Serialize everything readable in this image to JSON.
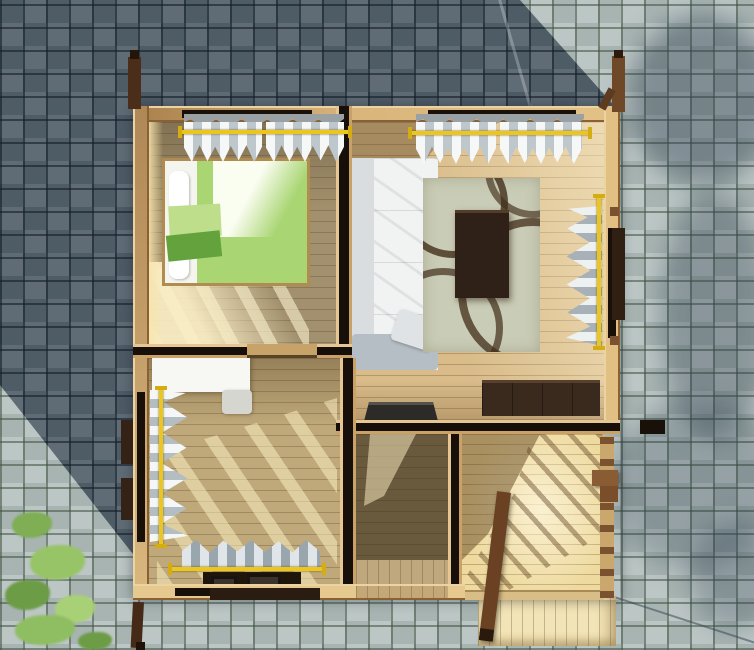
{
  "meta": {
    "type": "3d-architectural-render",
    "view": "top-down",
    "subject": "Single-storey wooden house interior seen from above, standing on a basketweave-paved courtyard",
    "lighting": "Sunlight from lower-right; building casts a large diagonal shadow over the paving to the upper-left",
    "image_size": "754x650"
  },
  "palette": {
    "paving_sunlit": "#b4bfbe",
    "paving_shadow": "#56646f",
    "paving_joint": "#3e5242",
    "wall_wood": "#cda269",
    "wall_gap_dark": "#191009",
    "floor_wood": "#c9ae7c",
    "floor_sunlit": "#f2e2b2",
    "bed_green": "#a9d673",
    "bed_green_dark": "#63a23c",
    "pillow_white": "#f5f5f0",
    "sofa_white": "#f1f3f3",
    "rug_sage": "#c9ccb6",
    "rug_swirl_brown": "#42301a",
    "coffee_table_brown": "#2f2018",
    "sideboard_brown": "#3a2a1d",
    "curtain_white": "#eef1f2",
    "curtain_gray": "#9aa6ad",
    "curtain_rod_yellow": "#ecc51e",
    "post_brown": "#4a2e1a",
    "shutter_brown": "#302013",
    "plant_green": "#8fbe62"
  },
  "ground": {
    "pattern": "basketweave concrete pavers with mossy joints",
    "building_shadow": "diagonal dark region covering upper-left paving",
    "tree_shadows": "soft foliage shadow patches along right edge",
    "plant": "green shrub in bottom-left corner",
    "cable_shadow": "thin diagonal line across bottom-right paving"
  },
  "house": {
    "structure": "log walls shown in cut top view with yellow curtain rods over window openings",
    "rooms": [
      {
        "id": "bedroom",
        "position": "top-left",
        "furniture": [
          "green double bed",
          "white headboard",
          "two white pillows",
          "dark-green folded blanket"
        ]
      },
      {
        "id": "living-room",
        "position": "top-right",
        "furniture": [
          "white sofa with cushions",
          "sage rug with brown swirl pattern",
          "dark-brown coffee table",
          "dark-brown sideboard",
          "dark stove block"
        ]
      },
      {
        "id": "second-room",
        "position": "bottom-left",
        "furniture": [
          "white desk",
          "light stool",
          "dark table with two trays"
        ]
      },
      {
        "id": "hallway",
        "position": "bottom-center",
        "furniture": []
      },
      {
        "id": "porch",
        "position": "bottom-right",
        "features": [
          "sunlit deck planks",
          "railing shadow stripes",
          "corner bracket",
          "diagonal support post",
          "steps landing"
        ]
      }
    ],
    "windows": [
      {
        "room": "bedroom",
        "wall": "top",
        "curtain": "white",
        "rod": "yellow"
      },
      {
        "room": "living-room",
        "wall": "top",
        "curtain": "white",
        "rod": "yellow"
      },
      {
        "room": "living-room",
        "wall": "right",
        "curtain": "white-gray",
        "rod": "yellow",
        "shutter": "dark brown outside"
      },
      {
        "room": "second-room",
        "wall": "left",
        "curtain": "white-gray",
        "rod": "yellow",
        "shutter": "dark brown outside"
      },
      {
        "room": "second-room",
        "wall": "bottom",
        "curtain": "gray",
        "rod": "yellow",
        "shutter": "dark brown outside"
      }
    ],
    "corner_posts": [
      "top-left",
      "top-right",
      "bottom-left",
      "porch support"
    ]
  }
}
